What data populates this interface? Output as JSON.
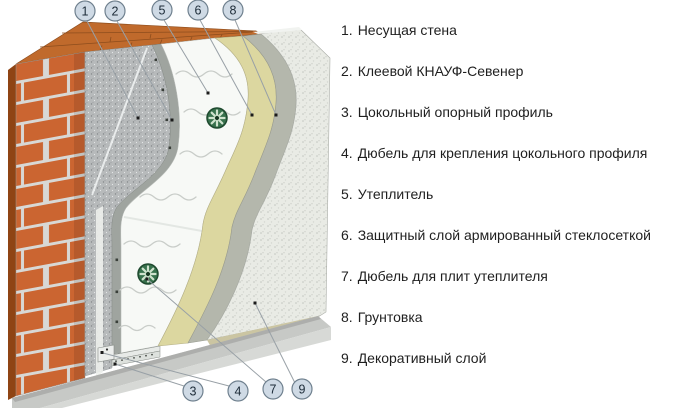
{
  "diagram": {
    "callouts": {
      "c1": "1",
      "c2": "2",
      "c3": "3",
      "c4": "4",
      "c5": "5",
      "c6": "6",
      "c7": "7",
      "c8": "8",
      "c9": "9"
    },
    "colors": {
      "brick": "#cb6531",
      "brick_side": "#8f4414",
      "brick_top": "#c06a2c",
      "mortar": "#d8d8d5",
      "bearing_wall_render": "#b7babb",
      "adhesive": "#9fa49f",
      "insulation": "#f7f9f6",
      "mesh_layer": "#dcd7a0",
      "primer": "#b4b7ac",
      "decorative": "#e9ebe5",
      "base_slab": "#c7c9c6",
      "base_profile": "#e7eae7",
      "dowel_green": "#37714c",
      "callout_fill": "#cfdae5",
      "callout_stroke": "#70818f",
      "leader_line": "#98a0a6"
    }
  },
  "legend": {
    "items": [
      {
        "num": "1.",
        "label": "Несущая стена"
      },
      {
        "num": "2.",
        "label": "Клеевой КНАУФ-Севенер"
      },
      {
        "num": "3.",
        "label": "Цокольный опорный профиль"
      },
      {
        "num": "4.",
        "label": "Дюбель для крепления цокольного профиля"
      },
      {
        "num": "5.",
        "label": "Утеплитель"
      },
      {
        "num": "6.",
        "label": "Защитный слой армированный стеклосеткой"
      },
      {
        "num": "7.",
        "label": "Дюбель для плит утеплителя"
      },
      {
        "num": "8.",
        "label": "Грунтовка"
      },
      {
        "num": "9.",
        "label": "Декоративный слой"
      }
    ]
  }
}
